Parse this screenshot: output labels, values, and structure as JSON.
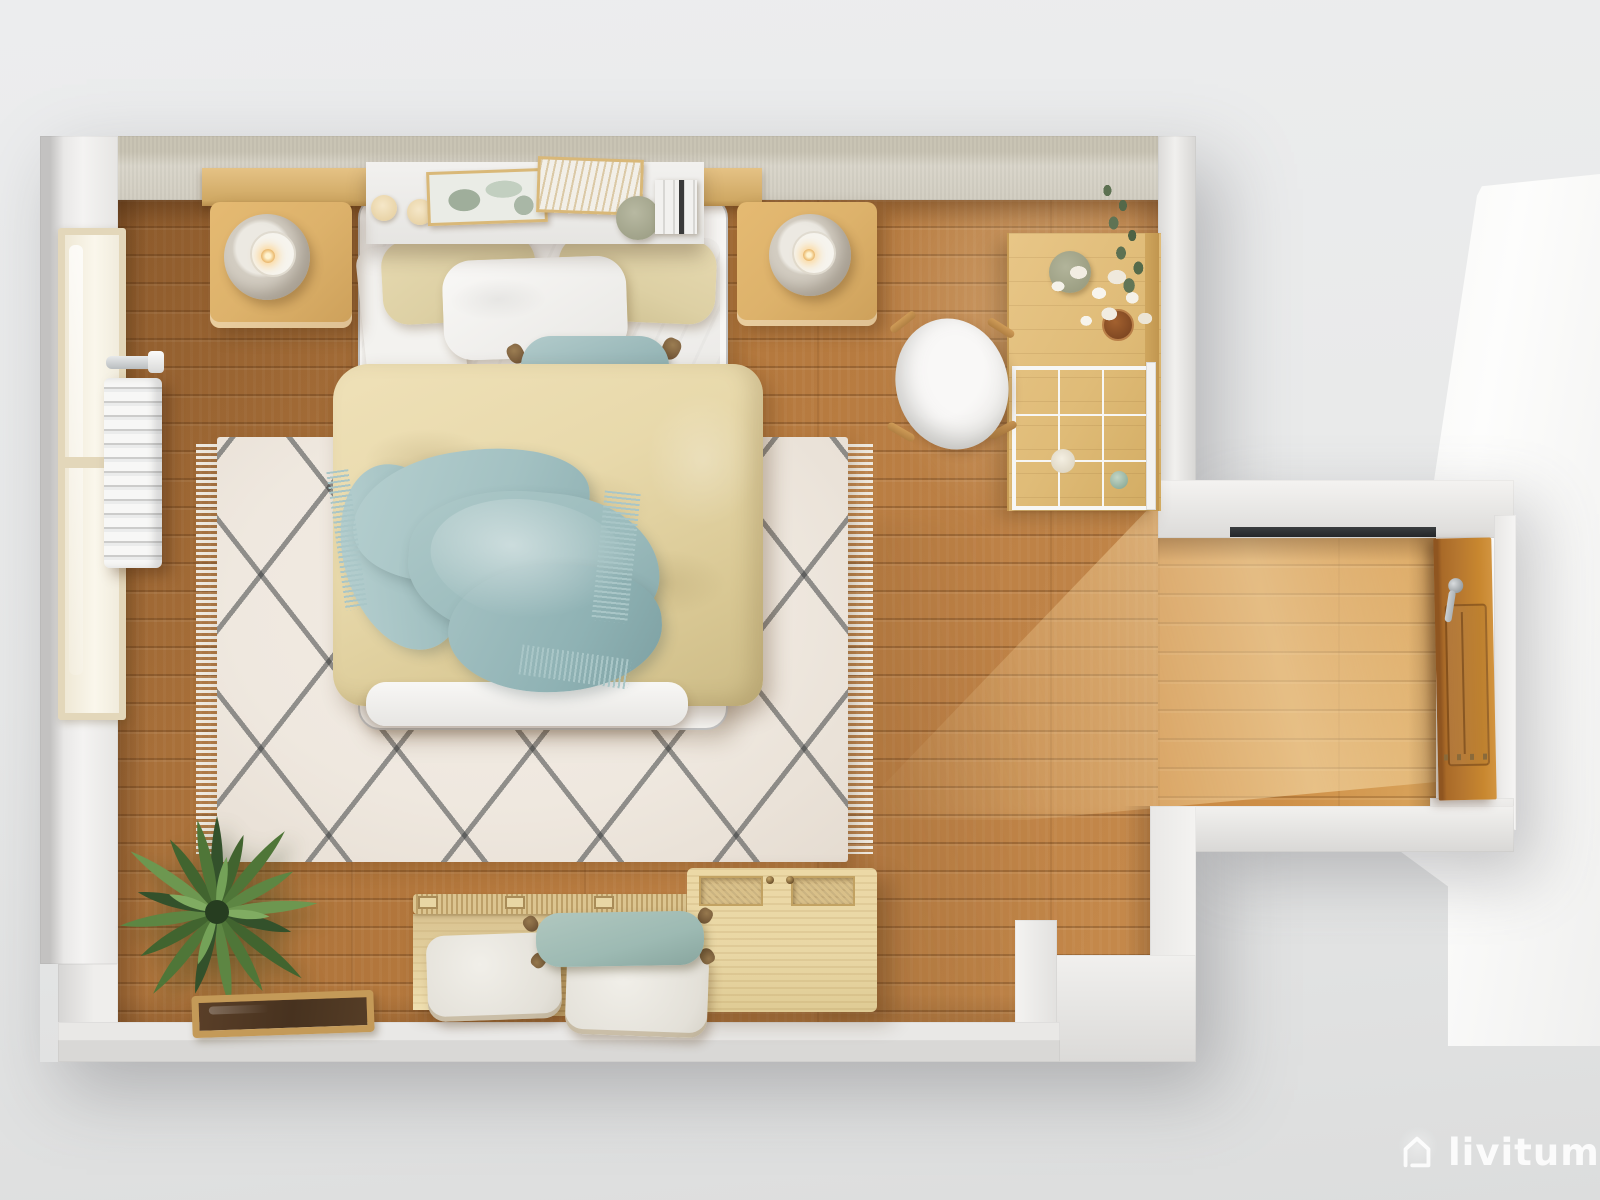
{
  "meta": {
    "type": "3d-render-top-view",
    "subject": "Top-down 3D render of a Scandinavian-style bedroom floor plan",
    "width": 1600,
    "height": 1200
  },
  "watermark": {
    "brand": "livitum",
    "icon": "house-outline-icon"
  },
  "palette": {
    "bg-top": "#ecedee",
    "bg-bottom": "#dcdddd",
    "wall-face": "#f3f2f0",
    "wall-top-band": "#ccc7b7",
    "floor-dark": "#9d6733",
    "floor-base": "#b3773c",
    "floor-light": "#c68a4b",
    "alcove-light": "#d9a45c",
    "rug-base": "#efe8df",
    "rug-line": "#303436",
    "rug-fringe": "#f2efe7",
    "duvet": "#e8d9ab",
    "sheet-white": "#f6f5f3",
    "pillow-beige": "#ddd0a4",
    "throw-teal": "#a3c1c2",
    "cushion-teal": "#9dbab3",
    "oak-light": "#ddb26b",
    "shelf-white": "#efeeec",
    "desk-wood": "#dfbb77",
    "door-wood": "#b5762f",
    "bench-wood": "#e5d2a0",
    "chest-wood": "#e9d7a5",
    "jute": "#c4a56c",
    "plant-green": "#4f7638",
    "tray-wood": "#c49a58",
    "tray-inner": "#47321f",
    "lamp-shade": "#d4cec3",
    "lamp-glow": "#eec27c",
    "watermark": "#ffffff"
  },
  "objects": [
    {
      "name": "double-bed",
      "label": "Double bed with beige quilted duvet"
    },
    {
      "name": "throw-blanket",
      "label": "Light blue fringed throw blanket"
    },
    {
      "name": "pillows",
      "label": "Two beige pillows, one white pillow"
    },
    {
      "name": "lumbar-cushion",
      "label": "Teal bolster cushion with tassels"
    },
    {
      "name": "headboard-shelf",
      "label": "White floating headboard shelf"
    },
    {
      "name": "candles",
      "label": "Two cream candles on shelf"
    },
    {
      "name": "picture-frames",
      "label": "Two framed prints on shelf"
    },
    {
      "name": "books",
      "label": "Stack of upright books on shelf"
    },
    {
      "name": "nightstand-left",
      "label": "Light oak nightstand with round lamp"
    },
    {
      "name": "nightstand-right",
      "label": "Light oak nightstand with round lamp"
    },
    {
      "name": "berber-rug",
      "label": "Cream diamond-pattern berber rug with fringe"
    },
    {
      "name": "radiator",
      "label": "White wall radiator"
    },
    {
      "name": "window",
      "label": "Wood-framed window on left wall"
    },
    {
      "name": "desk",
      "label": "Oak desk with white wire organizer"
    },
    {
      "name": "vase-flowers",
      "label": "Sage vase with white dried flowers and eucalyptus"
    },
    {
      "name": "chair",
      "label": "White shell chair with wood legs"
    },
    {
      "name": "door",
      "label": "Open wooden door in right hallway"
    },
    {
      "name": "threshold",
      "label": "Dark threshold strip at hallway"
    },
    {
      "name": "bench",
      "label": "Slatted wood bench with floor cushions"
    },
    {
      "name": "floor-cushions",
      "label": "Two boucle cushions and one teal cushion"
    },
    {
      "name": "storage-chest",
      "label": "Pine storage chest with woven lid panels"
    },
    {
      "name": "plant",
      "label": "Green leafy plant in corner"
    },
    {
      "name": "decorative-tray",
      "label": "Wooden tray with dark mirror base"
    },
    {
      "name": "wood-floor",
      "label": "Oak plank flooring"
    }
  ]
}
